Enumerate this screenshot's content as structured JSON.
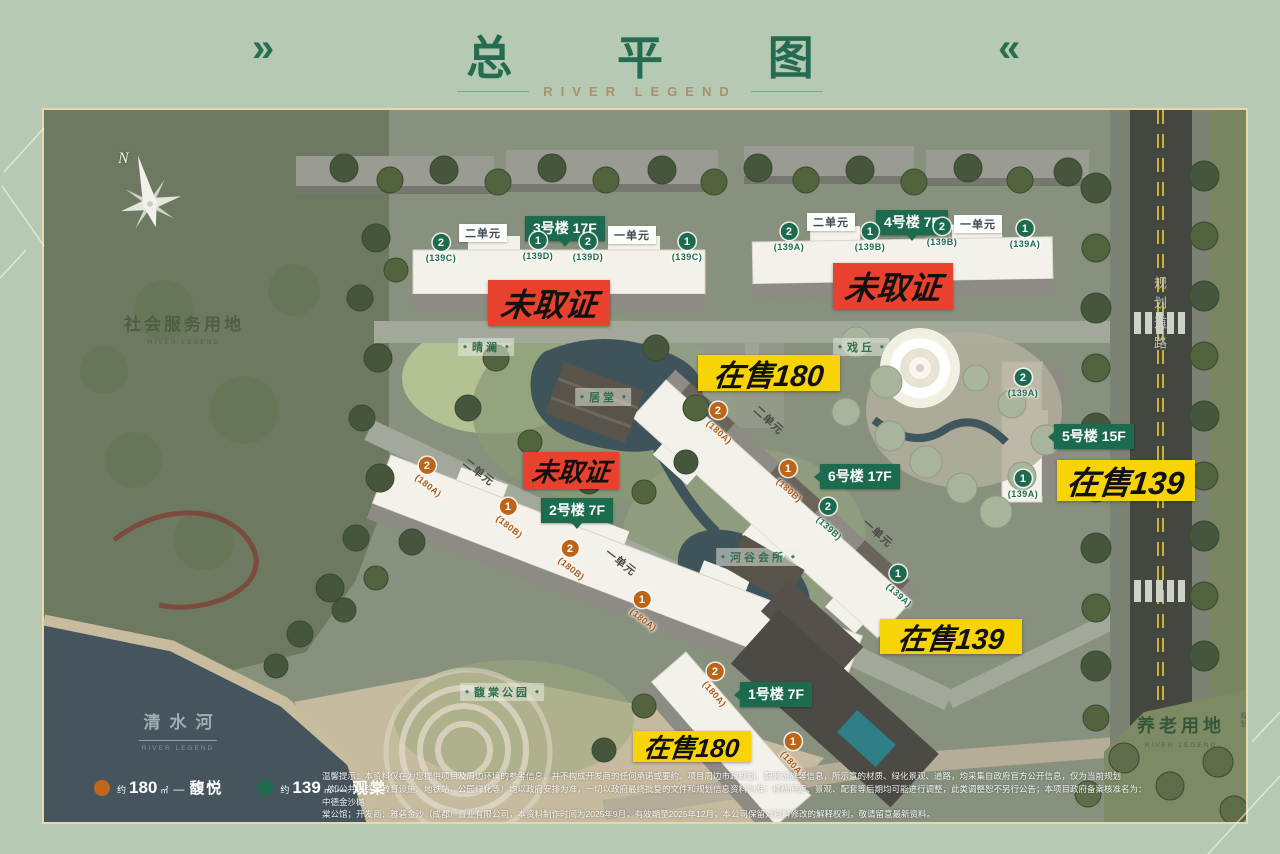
{
  "header": {
    "chevron_left": "»",
    "chevron_right": "«",
    "title": "总 平 图",
    "subtitle": "RIVER LEGEND"
  },
  "compass_n": "N",
  "icons": {
    "diamond": "◆"
  },
  "areas": {
    "social": {
      "name": "社会服务用地",
      "sub": "RIVER LEGEND"
    },
    "river": {
      "name": "清水河",
      "sub": "RIVER LEGEND"
    },
    "elder": {
      "name": "养老用地",
      "note": "规划",
      "sub": "RIVER LEGEND"
    },
    "road": {
      "name": "规划道路"
    }
  },
  "amenities": {
    "a1": "晴澜",
    "a2": "居堂",
    "a3": "戏丘",
    "a4": "河谷会所",
    "a5": "馥棠公园"
  },
  "badges": {
    "b1": "1号楼 7F",
    "b2": "2号楼 7F",
    "b3": "3号楼 17F",
    "b4": "4号楼 7F",
    "b5": "5号楼 15F",
    "b6": "6号楼 17F"
  },
  "labels": {
    "unit2": "二单元",
    "unit1": "一单元"
  },
  "units": [
    {
      "n": "2",
      "plan": "(139C)"
    },
    {
      "n": "1",
      "plan": "(139D)"
    },
    {
      "n": "2",
      "plan": "(139D)"
    },
    {
      "n": "1",
      "plan": "(139C)"
    },
    {
      "n": "2",
      "plan": "(139A)"
    },
    {
      "n": "1",
      "plan": "(139B)"
    },
    {
      "n": "2",
      "plan": "(139B)"
    },
    {
      "n": "1",
      "plan": "(139A)"
    },
    {
      "n": "2",
      "plan": "(139A)"
    },
    {
      "n": "1",
      "plan": "(139A)"
    },
    {
      "n": "2",
      "plan": "(180A)"
    },
    {
      "n": "1",
      "plan": "(180B)"
    },
    {
      "n": "2",
      "plan": "(139B)"
    },
    {
      "n": "1",
      "plan": "(139A)"
    },
    {
      "n": "2",
      "plan": "(180A)"
    },
    {
      "n": "1",
      "plan": "(180B)"
    },
    {
      "n": "2",
      "plan": "(180B)"
    },
    {
      "n": "1",
      "plan": "(180A)"
    },
    {
      "n": "2",
      "plan": "(180A)"
    },
    {
      "n": "1",
      "plan": "(180A)"
    }
  ],
  "status": {
    "no_permit": "未取证",
    "sale180": "在售180",
    "sale139": "在售139"
  },
  "legend": [
    {
      "approx": "约",
      "area": "180",
      "unit": "㎡",
      "dash": "—",
      "name": "馥悦",
      "color": "#c2661e"
    },
    {
      "approx": "约",
      "area": "139",
      "unit": "㎡",
      "dash": "—",
      "name": "观棠",
      "color": "#1e6b4f"
    }
  ],
  "disclaimer": {
    "l1": "温馨提示：本资料仅在为您提供项目及周边环境的参考信息，并不构成开发商的任何承诺或要约。项目周边市政规划、配套设施等信息，所示意的材质、绿化景观、道路，均采集自政府官方公开信息，仅为当前规划",
    "l2": "（如公共道路、教育设施、地铁站、公园绿化等）均以政府安排为准，一切以政府最终批复的文件和规划信息资料为准；楼栋间距、景观、配套等后期均可能进行调整，此类调整恕不另行公告；本项目政府备案核准名为：中德金沙樾",
    "l3": "棠公馆；开发商：雅砻金沙（成都）置业有限公司，本资料制作时间为2025年9月，有效期至2025年12月，本公司保留对资料修改的解释权利，敬请留意最新资料。"
  }
}
